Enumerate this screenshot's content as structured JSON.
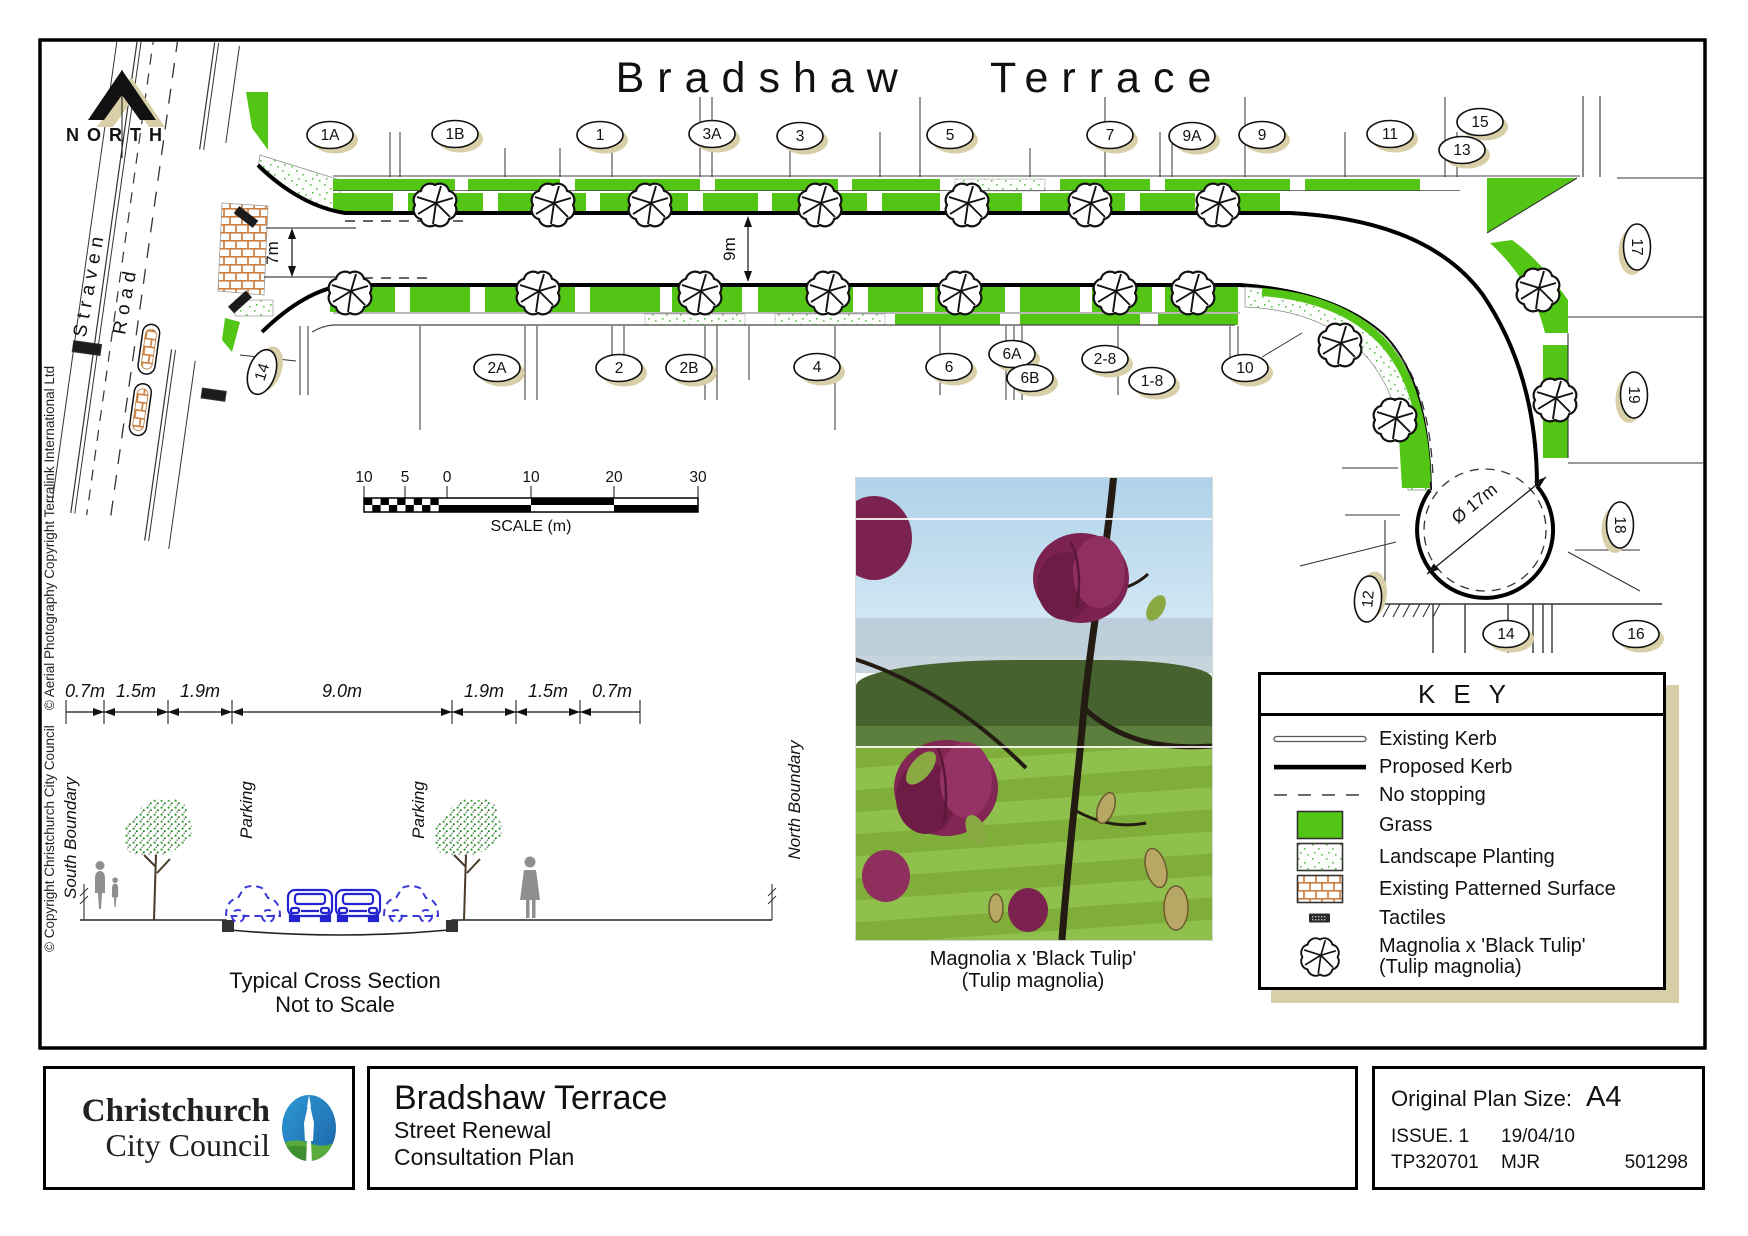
{
  "plan": {
    "title": "Bradshaw Terrace",
    "north_label": "NORTH",
    "straven_road": {
      "line1": "Straven",
      "line2": "Road"
    },
    "dimensions": {
      "entrance_width": "7m",
      "road_width": "9m",
      "culdesac_diameter": "Ø 17m"
    },
    "lots_top": [
      "1A",
      "1B",
      "1",
      "3A",
      "3",
      "5",
      "7",
      "9A",
      "9",
      "11",
      "15",
      "13"
    ],
    "lots_bottom": [
      "14",
      "2A",
      "2",
      "2B",
      "4",
      "6",
      "6A",
      "6B",
      "2-8",
      "1-8",
      "10"
    ],
    "lots_right": [
      "17",
      "19",
      "18",
      "16",
      "12",
      "14"
    ]
  },
  "scale_bar": {
    "ticks": [
      "10",
      "5",
      "0",
      "10",
      "20",
      "30"
    ],
    "label": "SCALE (m)"
  },
  "cross_section": {
    "dims": [
      "0.7m",
      "1.5m",
      "1.9m",
      "9.0m",
      "1.9m",
      "1.5m",
      "0.7m"
    ],
    "south_boundary_label": "South Boundary",
    "north_boundary_label": "North Boundary",
    "parking_label": "Parking",
    "caption_line1": "Typical Cross Section",
    "caption_line2": "Not to Scale"
  },
  "photo": {
    "caption_line1": "Magnolia x 'Black Tulip'",
    "caption_line2": "(Tulip magnolia)"
  },
  "key": {
    "title": "KEY",
    "items": [
      {
        "label": "Existing Kerb"
      },
      {
        "label": "Proposed Kerb"
      },
      {
        "label": "No stopping"
      },
      {
        "label": "Grass"
      },
      {
        "label": "Landscape Planting"
      },
      {
        "label": "Existing Patterned Surface"
      },
      {
        "label": "Tactiles"
      },
      {
        "label": "Magnolia x 'Black Tulip'",
        "label_line2": "(Tulip magnolia)"
      }
    ]
  },
  "title_block": {
    "logo_name_line1": "Christchurch",
    "logo_name_line2": "City Council",
    "project_title": "Bradshaw Terrace",
    "subtitle_line1": "Street Renewal",
    "subtitle_line2": "Consultation Plan",
    "plan_size_label": "Original Plan Size:",
    "plan_size_value": "A4",
    "issue": "ISSUE. 1",
    "date": "19/04/10",
    "drawing_number": "TP320701",
    "author": "MJR",
    "record_number": "501298"
  },
  "copyright_notice": "© Copyright Christchurch City Council    © Aerial Photography Copyright Terralink International Ltd",
  "colors": {
    "grass": "#52c515",
    "brick_lines": "#cd7f3f",
    "shadow_tan": "#d8cfa8",
    "logo_blue": "#2178be",
    "logo_green": "#5aaa3c",
    "car_blue": "#2323cf"
  }
}
